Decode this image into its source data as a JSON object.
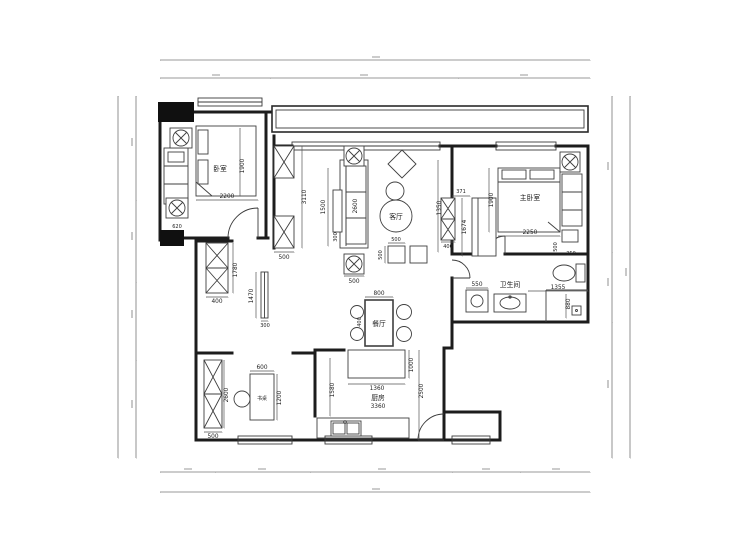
{
  "rooms": {
    "bedroom2": "卧室",
    "living": "客厅",
    "master": "主卧室",
    "bath": "卫生间",
    "dining": "餐厅",
    "kitchen": "厨房",
    "kitchen_width": "3360",
    "desk": "书桌"
  },
  "dims": {
    "bed2_width": "2200",
    "bed2_depth": "1900",
    "corner_col": "620",
    "hall_wall": "3110",
    "hall_col": "500",
    "sofa_side": "1500",
    "sofa_len": "2600",
    "sofa_table": "300",
    "fan_box": "500",
    "ottoman_w": "500",
    "ottoman_h": "500",
    "living_depth": "1350",
    "tv_offset": "371",
    "tv_unit": "400",
    "dresser": "1674",
    "master_depth": "1900",
    "master_bed": "2250",
    "nightstand_h": "500",
    "nightstand_w": "350",
    "washer": "550",
    "bath_width": "1355",
    "shower": "880",
    "cabinet_h": "1780",
    "cabinet_w": "400",
    "screen_h": "1470",
    "screen_w": "300",
    "table_w": "800",
    "chair": "400",
    "island_d": "1000",
    "island_w": "1360",
    "kitchen_d": "2500",
    "kitchen_left": "1580",
    "desk_w": "600",
    "desk_d": "1200",
    "shelf_h": "2600",
    "shelf_w": "500"
  }
}
